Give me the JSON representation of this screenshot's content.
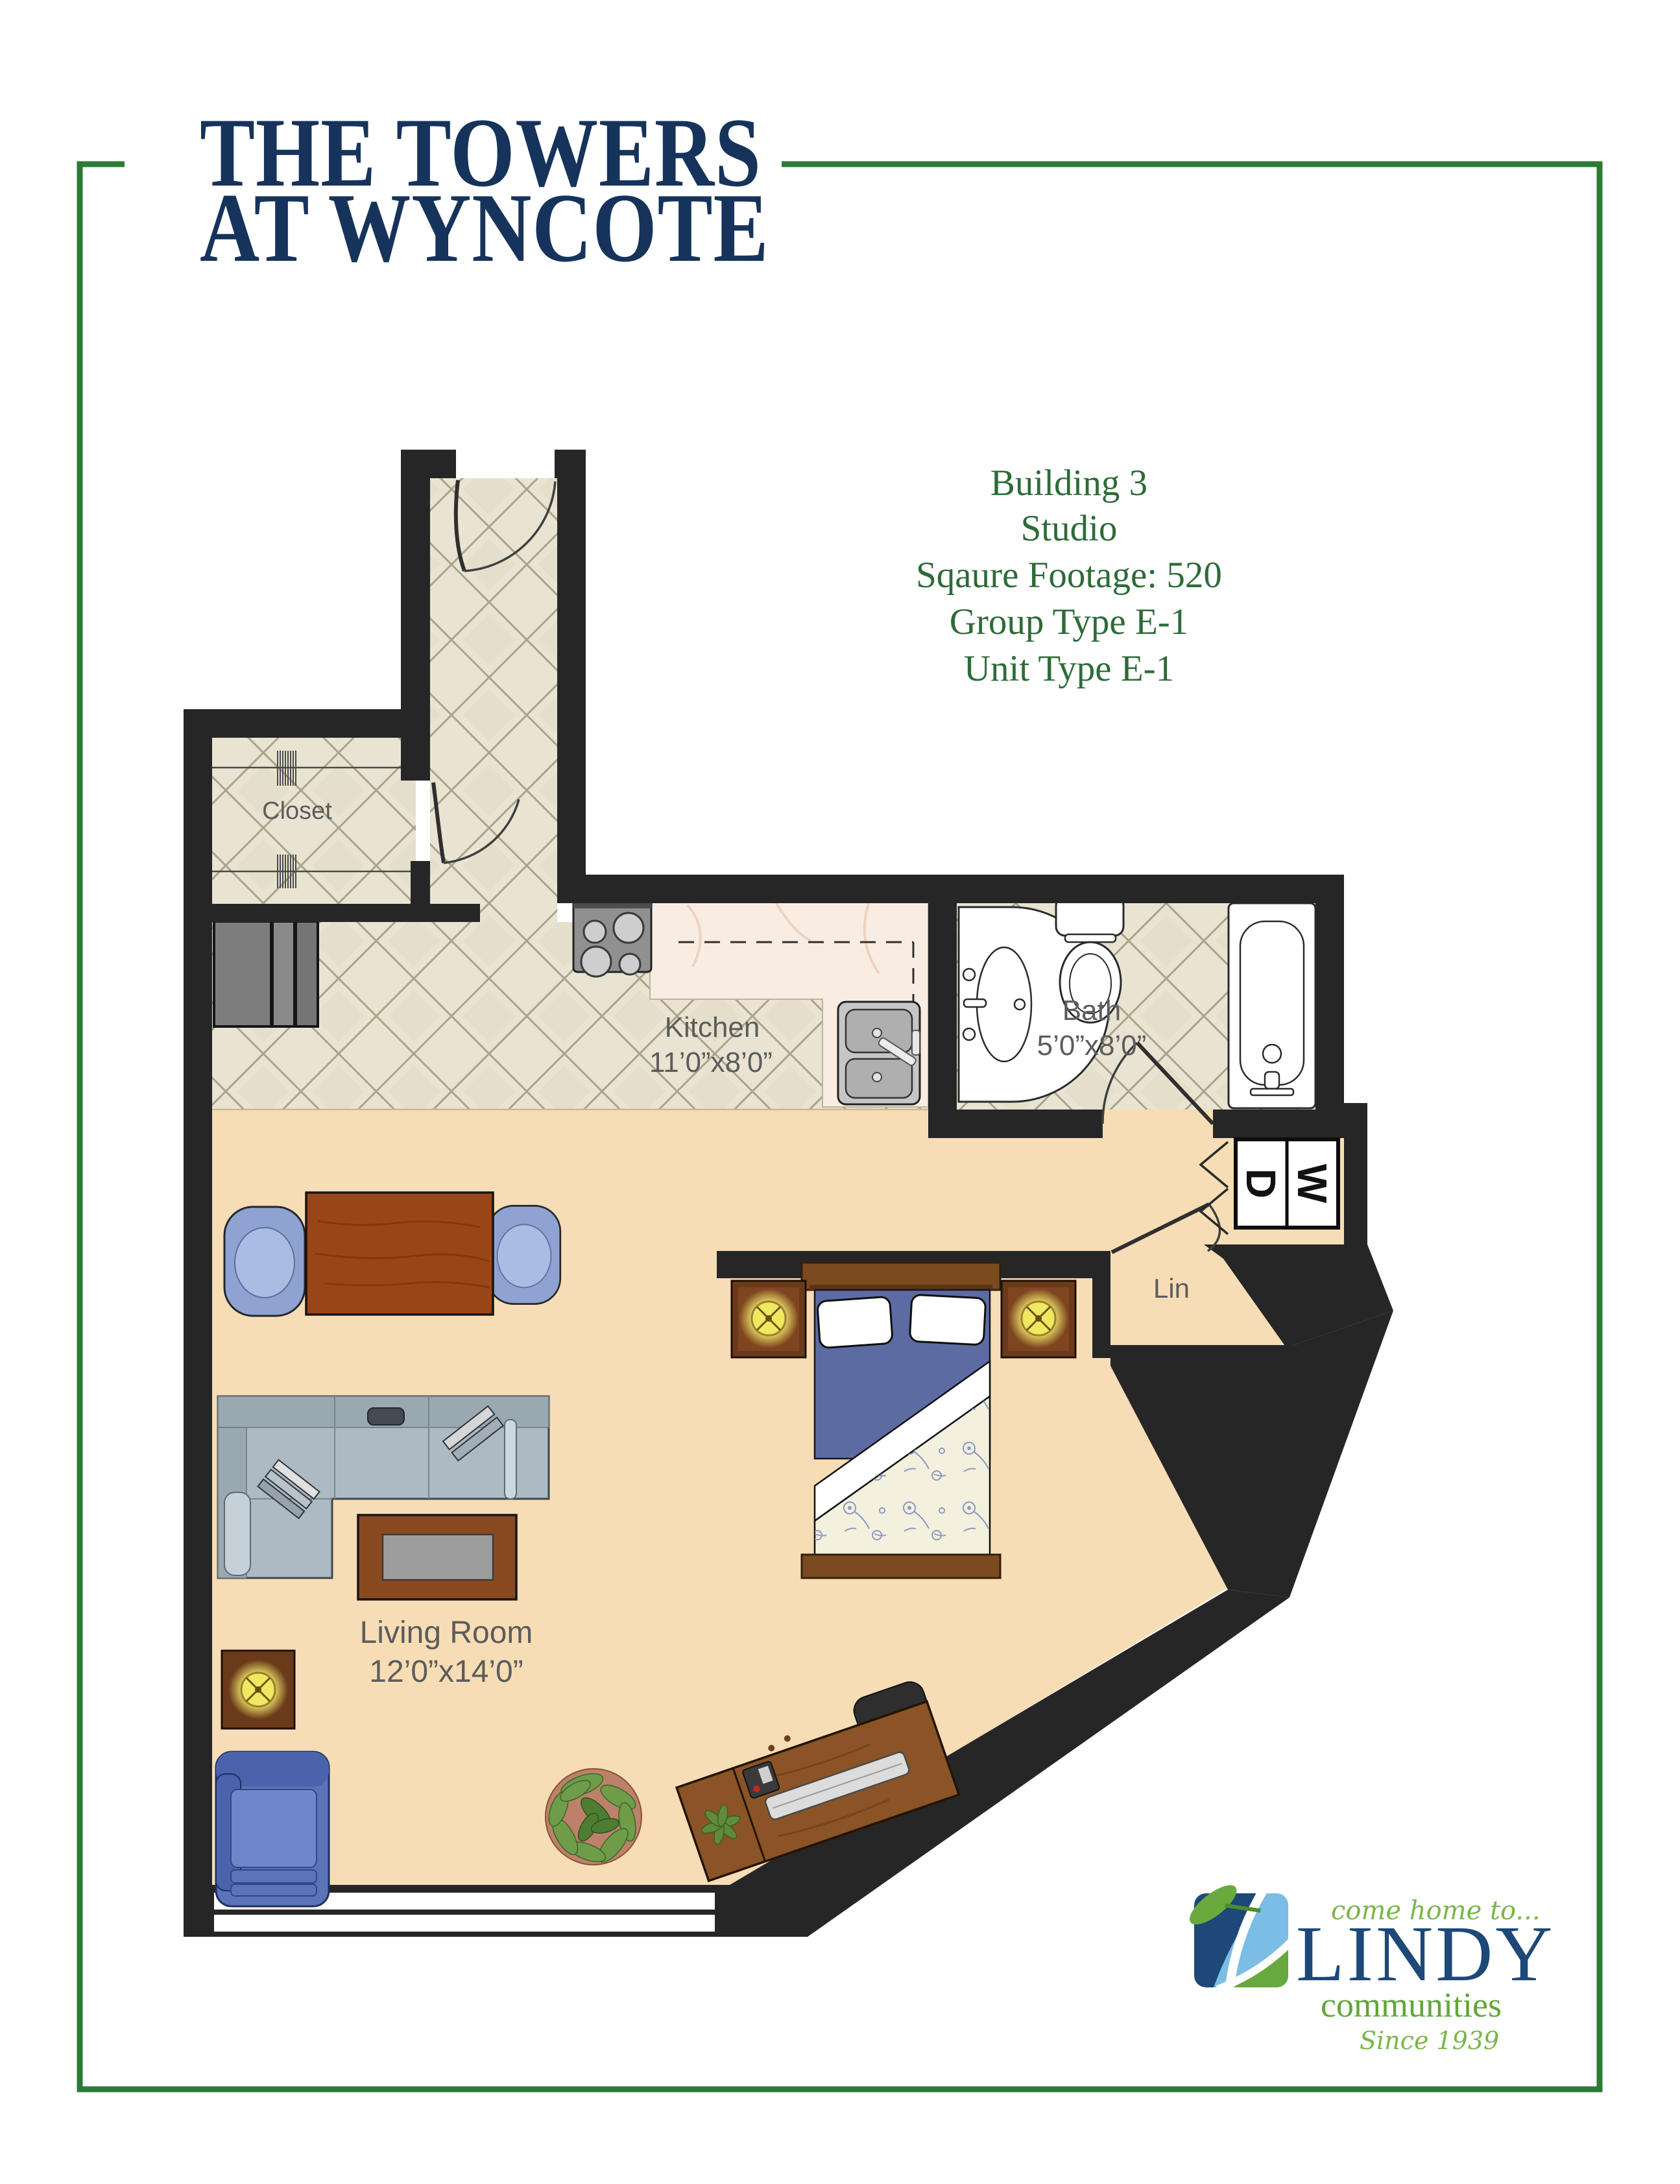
{
  "header": {
    "title_line1": "THE TOWERS",
    "title_line2": "AT WYNCOTE"
  },
  "info": {
    "lines": [
      "Building 3",
      "Studio",
      "Sqaure Footage: 520",
      "Group Type E-1",
      "Unit Type E-1"
    ]
  },
  "floorplan": {
    "rooms": {
      "closet": {
        "label": "Closet"
      },
      "kitchen": {
        "label": "Kitchen",
        "dims": "11’0”x8’0”"
      },
      "bath": {
        "label": "Bath",
        "dims": "5’0”x8’0”"
      },
      "linen": {
        "label": "Lin"
      },
      "living": {
        "label": "Living Room",
        "dims": "12’0”x14’0”"
      }
    },
    "appliances": {
      "washer": "W",
      "dryer": "D"
    }
  },
  "logo": {
    "tagline": "come home to...",
    "name": "LINDY",
    "subtitle": "communities",
    "since": "Since 1939"
  },
  "colors": {
    "frame_green": "#2c7a35",
    "title_navy": "#16335c",
    "info_green": "#2d6b38",
    "label_gray": "#5c5c5c",
    "wall_black": "#262626",
    "floor_peach": "#f7ddb5",
    "tile_beige": "#e9e4d2",
    "logo_navy": "#1d4878",
    "logo_blue": "#7bbde4",
    "logo_green": "#68a93d"
  }
}
